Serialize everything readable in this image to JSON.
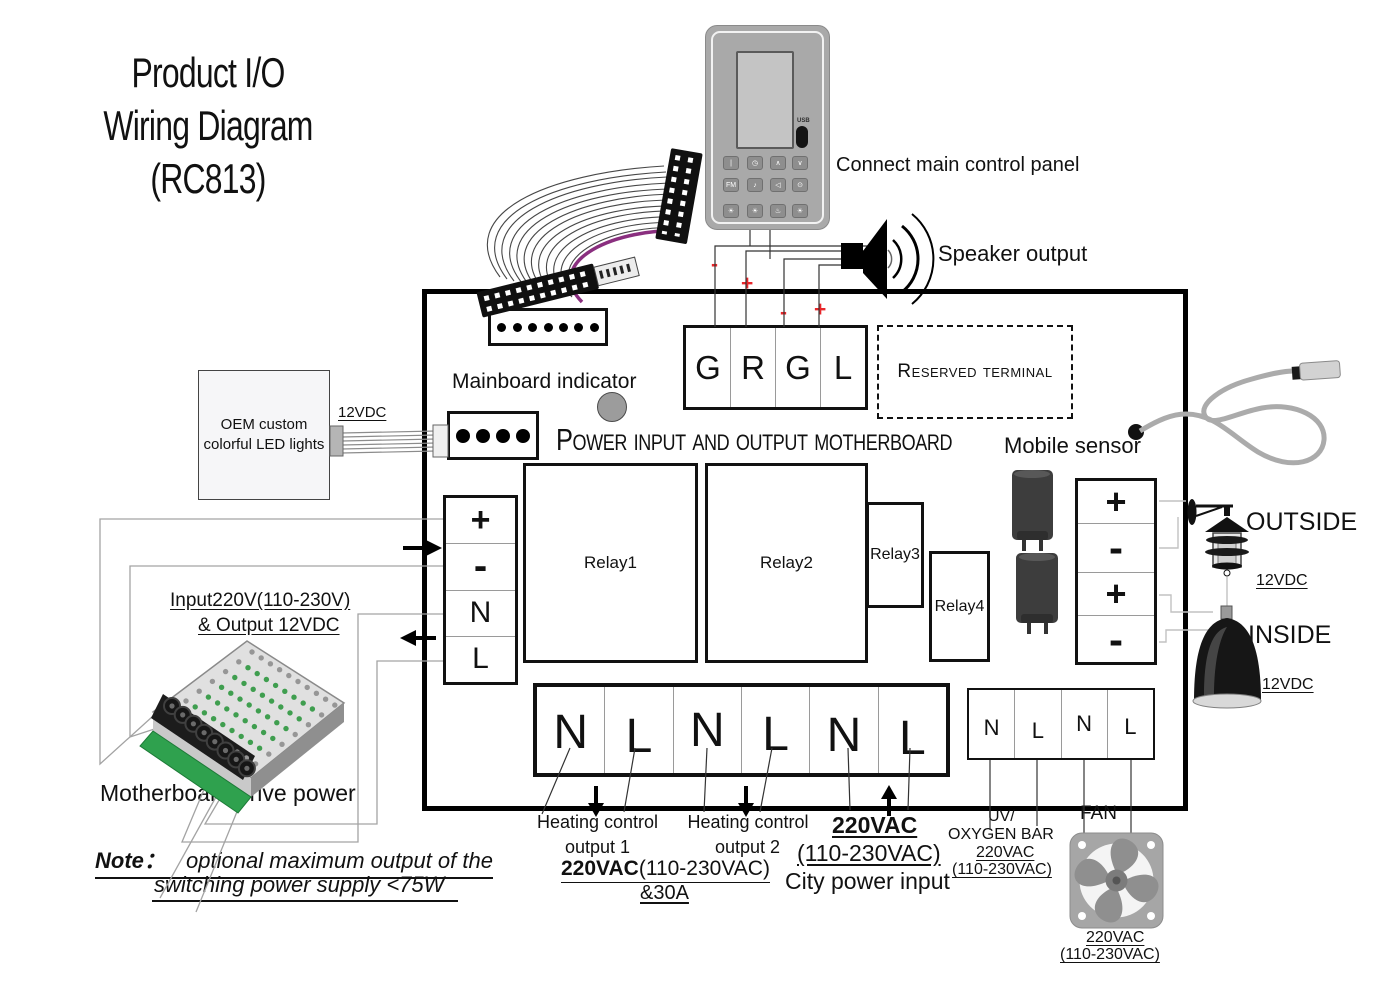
{
  "title": {
    "line1": "Product I/O",
    "line2": "Wiring Diagram",
    "line3": "(RC813)"
  },
  "panel": {
    "usb": "USB",
    "buttons": [
      "|",
      "◷",
      "∧",
      "∨",
      "FM",
      "♪",
      "◁",
      "⊙",
      "☀",
      "☀",
      "♨",
      "☀"
    ]
  },
  "labels": {
    "connect_panel": "Connect main control panel",
    "speaker_output": "Speaker output",
    "mainboard_indicator": "Mainboard indicator",
    "board_heading": "Power input and output motherboard",
    "reserved": "Reserved terminal",
    "mobile_sensor": "Mobile sensor",
    "outside": "OUTSIDE",
    "inside": "INSIDE",
    "outside_v": "12VDC",
    "inside_v": "12VDC",
    "fan": "FAN",
    "oem1": "OEM custom",
    "oem2": "colorful LED lights",
    "led_v": "12VDC",
    "psu1": "Input220V(110-230V)",
    "psu2": "& Output 12VDC",
    "psu_name": "Motherboard drive power"
  },
  "note": {
    "prefix": "Note：",
    "line1": "optional maximum output of the",
    "line2": "switching power supply <75W"
  },
  "terminals": {
    "grgl": [
      "G",
      "R",
      "G",
      "L"
    ],
    "left": [
      "+",
      "-",
      "N",
      "L"
    ],
    "right": [
      "+",
      "-",
      "+",
      "-"
    ],
    "bottom": [
      "N",
      "L",
      "N",
      "L",
      "N",
      "L"
    ],
    "bottom_right": [
      "N",
      "L",
      "N",
      "L"
    ]
  },
  "relays": [
    "Relay1",
    "Relay2",
    "Relay3",
    "Relay4"
  ],
  "marks": {
    "m1": "-",
    "m2": "+",
    "m3": "-",
    "m4": "+"
  },
  "outputs": {
    "heating1": {
      "t1": "Heating control",
      "t2": "output 1",
      "v_bold": "220VAC",
      "v_rest": "(110-230VAC)",
      "amp": "&30A"
    },
    "heating2": {
      "t1": "Heating control",
      "t2": "output 2"
    },
    "city": {
      "v_bold": "220VAC",
      "v2": "(110-230VAC)",
      "t": "City power input"
    },
    "uv": {
      "t1": "UV/",
      "t2": "OXYGEN BAR",
      "v1": "220VAC",
      "v2": "(110-230VAC)"
    },
    "fan": {
      "v1": "220VAC",
      "v2": "(110-230VAC)"
    }
  },
  "colors": {
    "accent_red": "#e8262a",
    "ribbon_purple": "#8a2f7f",
    "pcb_green": "#2fa14e"
  }
}
